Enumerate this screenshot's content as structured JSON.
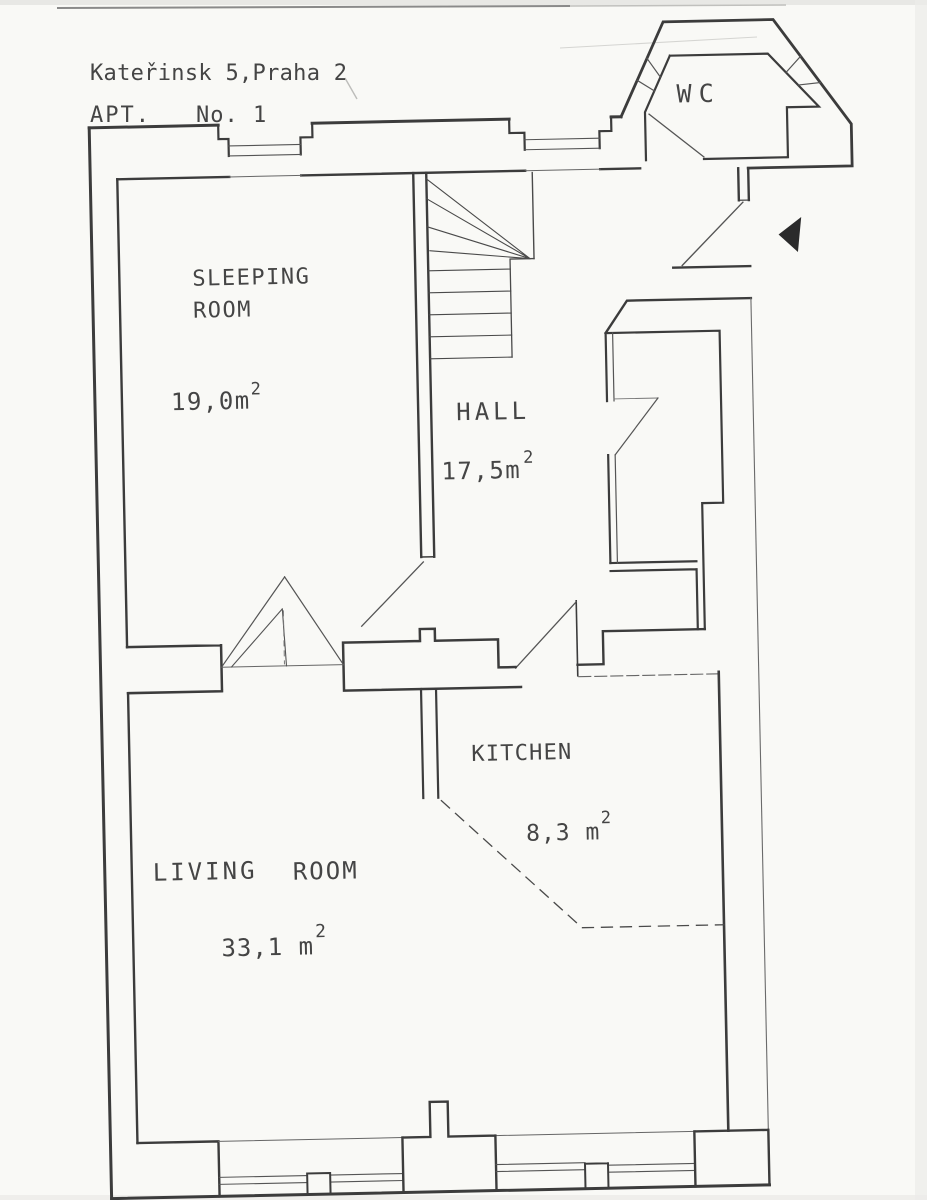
{
  "document": {
    "type": "scanned floor plan",
    "address": "Kateřinsk 5,Praha 2",
    "apt_label": "APT.",
    "apt_number": "No. 1"
  },
  "rooms": [
    {
      "id": "wc",
      "label": "WC",
      "area": "",
      "sup": ""
    },
    {
      "id": "sleeping",
      "line1": "SLEEPING",
      "line2": "ROOM",
      "area": "19,0m",
      "sup": "2"
    },
    {
      "id": "hall",
      "label": "HALL",
      "area": "17,5m",
      "sup": "2"
    },
    {
      "id": "kitchen",
      "label": "KITCHEN",
      "area": "8,3 m",
      "sup": "2"
    },
    {
      "id": "living",
      "word1": "LIVING",
      "word2": "ROOM",
      "area": "33,1 m",
      "sup": "2"
    }
  ],
  "icons": {
    "entrance_arrow": "filled-triangle-pointing-left"
  },
  "colors": {
    "ink": "#3c3c3c",
    "thin_ink": "#555555",
    "paper": "#f9f9f6",
    "arrow_fill": "#2b2b2b"
  }
}
